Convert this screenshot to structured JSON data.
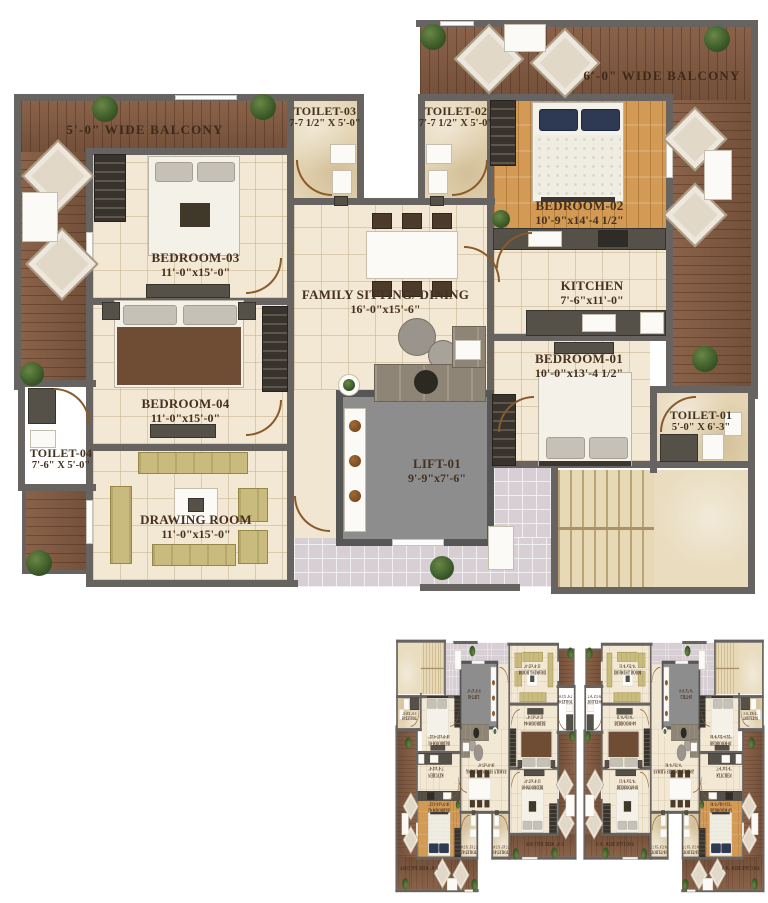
{
  "plan": {
    "rooms": {
      "balcony_left": {
        "name": "5'-0\" WIDE BALCONY"
      },
      "balcony_right": {
        "name": "6'-0\" WIDE BALCONY"
      },
      "toilet03": {
        "name": "TOILET-03",
        "dims": "7-7 1/2\" X 5'-0\""
      },
      "toilet02": {
        "name": "TOILET-02",
        "dims": "7'-7 1/2\" X 5'-0\""
      },
      "bedroom03": {
        "name": "BEDROOM-03",
        "dims": "11'-0\"x15'-0\""
      },
      "bedroom02": {
        "name": "BEDROOM-02",
        "dims": "10'-9\"x14'-4 1/2\""
      },
      "family_dining": {
        "name": "FAMILY SITTING/ DINING",
        "dims": "16'-0\"x15'-6\""
      },
      "kitchen": {
        "name": "KITCHEN",
        "dims": "7'-6\"x11'-0\""
      },
      "bedroom01": {
        "name": "BEDROOM-01",
        "dims": "10'-0\"x13'-4 1/2\""
      },
      "bedroom04": {
        "name": "BEDROOM-04",
        "dims": "11'-0\"x15'-0\""
      },
      "drawing_room": {
        "name": "DRAWING ROOM",
        "dims": "11'-0\"x15'-0\""
      },
      "toilet04": {
        "name": "TOILET-04",
        "dims": "7'-6\" X 5'-0\""
      },
      "toilet01": {
        "name": "TOILET-01",
        "dims": "5'-0\" X 6'-3\""
      },
      "lift": {
        "name": "LIFT-01",
        "dims": "9'-9\"x7'-6\""
      }
    },
    "palette": {
      "wall": "#676360",
      "balcony_wood": "#82593f",
      "bedroom02_wood": "#d29a55",
      "floor_cream": "#f2e8d4",
      "toilet_floor": "#e4d4b2",
      "lift_gray": "#8d8d8d",
      "stair_beige": "#e7d9b6",
      "lobby_lavender": "#d8cfd4",
      "label_brown": "#45311f"
    }
  }
}
